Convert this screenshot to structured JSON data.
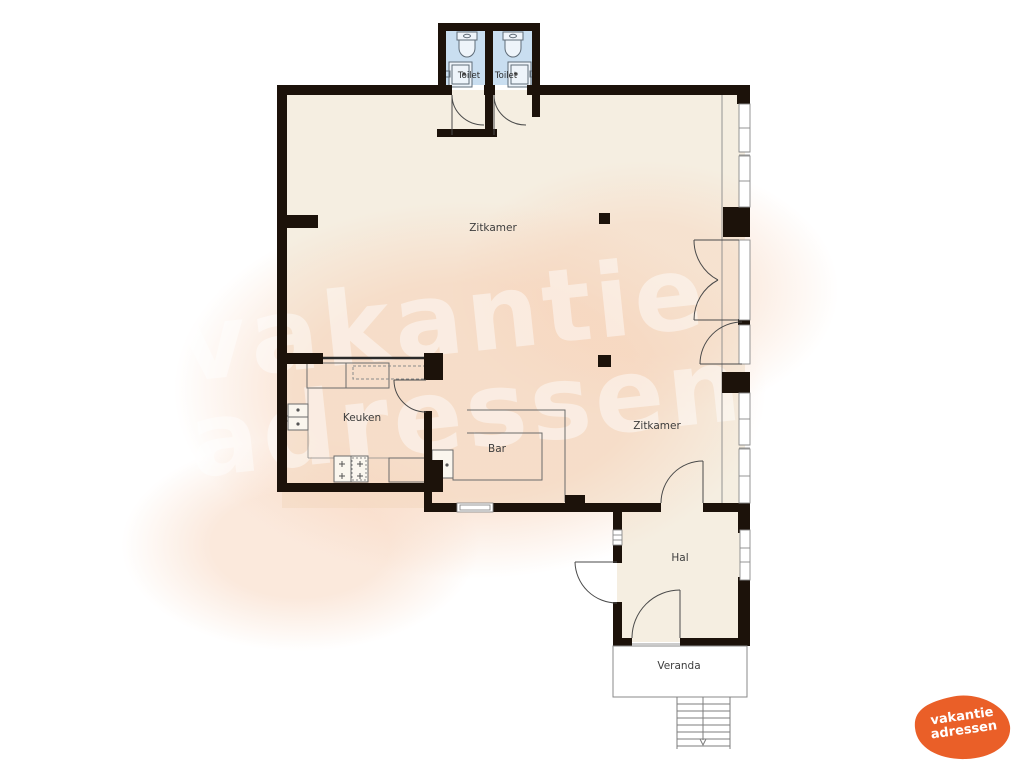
{
  "floorplan": {
    "rooms": [
      {
        "id": "toilet-left",
        "label": "Toilet"
      },
      {
        "id": "toilet-right",
        "label": "Toilet"
      },
      {
        "id": "zitkamer-upper",
        "label": "Zitkamer"
      },
      {
        "id": "keuken",
        "label": "Keuken"
      },
      {
        "id": "bar",
        "label": "Bar"
      },
      {
        "id": "zitkamer-lower",
        "label": "Zitkamer"
      },
      {
        "id": "hal",
        "label": "Hal"
      },
      {
        "id": "veranda",
        "label": "Veranda"
      }
    ],
    "colors": {
      "wall": "#1c120a",
      "floor": "#f5eee1",
      "toilet_floor": "#c9def0",
      "thin_line": "#5a5a5a",
      "background_blob": "#f7d3ba"
    }
  },
  "watermark": {
    "line1": "vakantie",
    "line2": "adressen"
  },
  "logo": {
    "line1": "vakantie",
    "line2": "adressen",
    "color": "#ea5f28"
  }
}
